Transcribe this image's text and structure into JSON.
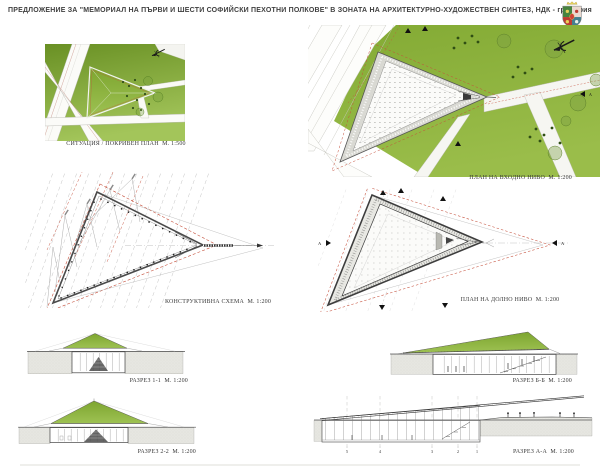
{
  "header": {
    "title": "ПРЕДЛОЖЕНИЕ ЗА \"МЕМОРИАЛ НА ПЪРВИ И ШЕСТИ СОФИЙСКИ ПЕХОТНИ ПОЛКОВЕ\" В ЗОНАТА НА АРХИТЕКТУРНО-ХУДОЖЕСТВЕН СИНТЕЗ, НДК - гр.София",
    "logo": "Sofia coat of arms"
  },
  "icons": {
    "north_arrow_icon": "stylized north arrow",
    "coat_of_arms_icon": "Sofia municipal coat of arms"
  },
  "colors": {
    "grass_green": "#8db13d",
    "dark_green_trees": "#2f4e14",
    "red_dashed_lines": "#c5503c",
    "ground_gray": "#e6e6e1",
    "drawing_line": "#4a4a4a",
    "title_text": "#3f3f3f"
  },
  "panels": {
    "site_plan": {
      "caption": "СИТУАЦИЯ / ПОКРИВЕН ПЛАН  М. 1:500"
    },
    "entry_plan": {
      "caption": "ПЛАН НА ВХОДНО НИВО  М. 1:200",
      "section_label": "А"
    },
    "construction_scheme": {
      "caption": "КОНСТРУКТИВНА СХЕМА  М. 1:200"
    },
    "lower_plan": {
      "caption": "ПЛАН НА ДОЛНО НИВО  М. 1:200",
      "section_label_left": "А",
      "section_label_right": "А"
    },
    "section_1_1": {
      "caption": "РАЗРЕЗ 1-1  М. 1:200"
    },
    "section_2_2": {
      "caption": "РАЗРЕЗ 2-2  М. 1:200"
    },
    "section_b_b": {
      "caption": "РАЗРЕЗ Б-Б  М. 1:200"
    },
    "section_a_a": {
      "caption": "РАЗРЕЗ А-А  М. 1:200",
      "grid_labels": [
        "5",
        "4",
        "3",
        "2",
        "1"
      ]
    }
  }
}
